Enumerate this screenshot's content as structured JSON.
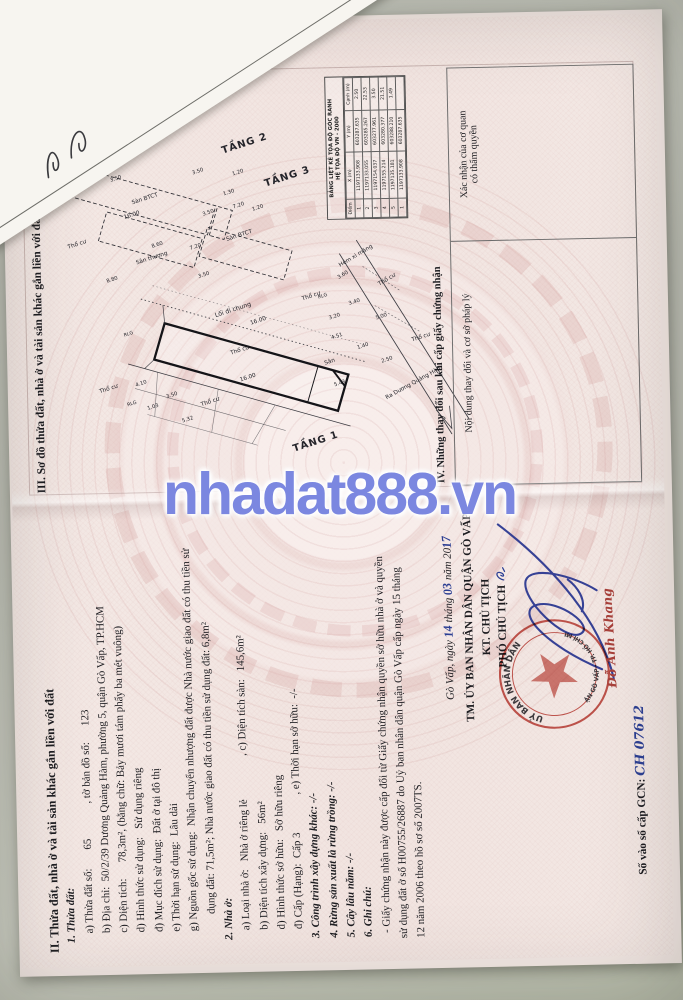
{
  "watermark": "nhadat888.vn",
  "page2": {
    "section2_title": "II. Thửa đất, nhà ở và tài sản khác gắn liền với đất",
    "lines": [
      {
        "t": "1. Thửa đất:",
        "cls": "bi",
        "ind": 10
      },
      {
        "t": "a) Thửa đất số:       65             , tờ bản đồ số:      123",
        "cls": "n",
        "ind": 20
      },
      {
        "t": "b) Địa chỉ:  50/2/39 Dương Quảng Hàm, phường 5, quận Gò Vấp, TP.HCM",
        "cls": "n",
        "ind": 20
      },
      {
        "t": "c) Diện tích:      78,3m², (bằng chữ: Bảy mươi tám phẩy ba mét vuông)",
        "cls": "n",
        "ind": 20
      },
      {
        "t": "d) Hình thức sử dụng:   Sử dụng riêng",
        "cls": "n",
        "ind": 20
      },
      {
        "t": "đ) Mục đích sử dụng:  Đất ở tại đô thị",
        "cls": "n",
        "ind": 20
      },
      {
        "t": "e) Thời hạn sử dụng:  Lâu dài",
        "cls": "n",
        "ind": 20
      },
      {
        "t": "g) Nguồn gốc sử dụng:  Nhận chuyển nhượng đất được Nhà nước giao đất có thu tiền sử",
        "cls": "n",
        "ind": 20
      },
      {
        "t": "dụng đất: 71,5m²; Nhà nước giao đất có thu tiền sử dụng đất: 6,8m²",
        "cls": "n",
        "ind": 38
      },
      {
        "t": "2. Nhà ở:",
        "cls": "bi",
        "ind": 10
      },
      {
        "t": "a) Loại nhà ở:   Nhà ở riêng lẻ                , c) Diện tích sàn:   145,6m²",
        "cls": "n",
        "ind": 20
      },
      {
        "t": "b) Diện tích xây dựng:   56m²",
        "cls": "n",
        "ind": 20
      },
      {
        "t": "d) Hình thức sở hữu:   Sở hữu riêng",
        "cls": "n",
        "ind": 20
      },
      {
        "t": "đ) Cấp (Hạng):  Cấp 3              , e) Thời hạn sở hữu:  -/-",
        "cls": "n",
        "ind": 20
      },
      {
        "t": "3. Công trình xây dựng khác: -/-",
        "cls": "bi",
        "ind": 10
      },
      {
        "t": "4. Rừng sản xuất là rừng trồng: -/-",
        "cls": "bi",
        "ind": 10
      },
      {
        "t": "5. Cây lâu năm: -/-",
        "cls": "bi",
        "ind": 10
      },
      {
        "t": "6. Ghi chú:",
        "cls": "bi",
        "ind": 10
      },
      {
        "t": "- Giấy chứng nhận này được cấp đổi từ Giấy chứng nhận quyền sở hữu nhà ở và quyền",
        "cls": "n",
        "ind": 14
      },
      {
        "t": "sử dụng đất ở số H00755/26887 do Uỷ ban nhân dân quận Gò Vấp cấp ngày 15 tháng",
        "cls": "n",
        "ind": 8
      },
      {
        "t": "12 năm 2006 theo hồ sơ số 2007TS.",
        "cls": "n",
        "ind": 8
      }
    ],
    "sign": {
      "place": "Gò Vấp, ngày ",
      "day": "14",
      "thang": " tháng ",
      "month": "03",
      "nam": " năm 20",
      "year": "17",
      "authority": "TM. ỦY BAN NHÂN DÂN QUẬN GÒ VẤP",
      "kt": "KT. CHỦ TỊCH",
      "deputy": "PHÓ CHỦ TỊCH",
      "signer": "Đỗ Anh Khang",
      "seal_top": "UỶ BAN NHÂN DÂN",
      "seal_bottom": "QUẬN GÒ VẤP · TP. HỒ CHÍ MINH",
      "gcn_label": "Số vào sổ cấp GCN: ",
      "gcn_value": "CH 07612"
    }
  },
  "page3": {
    "section3_title": "III. Sơ đồ thửa đất, nhà ở và tài sản khác gắn liền với đất",
    "coord_table": {
      "title1": "BẢNG LIỆT KÊ TỌA ĐỘ GÓC RANH",
      "title2": "HỆ TỌA ĐỘ VN - 2000",
      "headers": [
        "Điểm",
        "X (m)",
        "Y (m)",
        "Cạnh (m)"
      ],
      "rows": [
        [
          "1",
          "1197133.908",
          "603287.635",
          "2.50"
        ],
        [
          "2",
          "1197133.055",
          "603285.267",
          "22.53"
        ],
        [
          "3",
          "1197154.037",
          "603277.961",
          "3.50"
        ],
        [
          "4",
          "1197155.214",
          "603280.377",
          "21.51"
        ],
        [
          "5",
          "1197135.181",
          "603288.210",
          "1.49"
        ],
        [
          "1",
          "1197133.908",
          "603287.635",
          ""
        ]
      ]
    },
    "section4_title": "IV. Những thay đổi sau khi cấp giấy chứng nhận",
    "col1_header": "Nội dung thay đổi và cơ sở pháp lý",
    "col2_header_line1": "Xác nhận của cơ quan",
    "col2_header_line2": "có thẩm quyền",
    "plan_labels": [
      {
        "t": "TẦNG 1",
        "x": 50,
        "y": 320,
        "r": 73,
        "s": 10.5,
        "b": 1
      },
      {
        "t": "TẦNG 2",
        "x": 368,
        "y": 252,
        "r": 73,
        "s": 10.5,
        "b": 1
      },
      {
        "t": "TẦNG 3",
        "x": 332,
        "y": 296,
        "r": 73,
        "s": 10.5,
        "b": 1
      },
      {
        "t": "Sàn BTCT",
        "x": 313,
        "y": 146,
        "r": 73,
        "s": 6
      },
      {
        "t": "Sàn BTCT",
        "x": 272,
        "y": 244,
        "r": 73,
        "s": 6
      },
      {
        "t": "Sân thượng",
        "x": 250,
        "y": 152,
        "r": 73,
        "s": 6
      },
      {
        "t": "Sân",
        "x": 136,
        "y": 336,
        "r": 73,
        "s": 6
      },
      {
        "t": "Lối đi chung",
        "x": 193,
        "y": 236,
        "r": 73,
        "s": 6.5
      },
      {
        "t": "Hẻm xi măng",
        "x": 248,
        "y": 366,
        "r": 60,
        "s": 6
      },
      {
        "t": "Ra Dương Quảng Hàm",
        "x": 112,
        "y": 424,
        "r": 62,
        "s": 6
      },
      {
        "t": "16.00",
        "x": 121,
        "y": 250,
        "r": 73,
        "s": 6
      },
      {
        "t": "16.00",
        "x": 181,
        "y": 262,
        "r": 73,
        "s": 6
      },
      {
        "t": "16.00",
        "x": 296,
        "y": 132,
        "r": 73,
        "s": 6
      },
      {
        "t": "3.50",
        "x": 335,
        "y": 116,
        "r": 73,
        "s": 5.5
      },
      {
        "t": "3.50",
        "x": 341,
        "y": 202,
        "r": 73,
        "s": 5.5
      },
      {
        "t": "1.30",
        "x": 318,
        "y": 234,
        "r": 73,
        "s": 5.5
      },
      {
        "t": "1.20",
        "x": 339,
        "y": 244,
        "r": 73,
        "s": 5.5
      },
      {
        "t": "8.80",
        "x": 228,
        "y": 110,
        "r": 73,
        "s": 5.5
      },
      {
        "t": "8.60",
        "x": 264,
        "y": 158,
        "r": 73,
        "s": 5.5
      },
      {
        "t": "3.50",
        "x": 231,
        "y": 206,
        "r": 73,
        "s": 5.5
      },
      {
        "t": "7.20",
        "x": 261,
        "y": 198,
        "r": 73,
        "s": 5.5
      },
      {
        "t": "7.20",
        "x": 304,
        "y": 244,
        "r": 73,
        "s": 5.5
      },
      {
        "t": "3.50",
        "x": 297,
        "y": 212,
        "r": 73,
        "s": 5.5
      },
      {
        "t": "1.20",
        "x": 301,
        "y": 264,
        "r": 73,
        "s": 5.5
      },
      {
        "t": "1.03",
        "x": 92,
        "y": 150,
        "r": 73,
        "s": 5.5
      },
      {
        "t": "4.10",
        "x": 117,
        "y": 138,
        "r": 73,
        "s": 5.5
      },
      {
        "t": "3.50",
        "x": 104,
        "y": 170,
        "r": 73,
        "s": 5.5
      },
      {
        "t": "5.32",
        "x": 78,
        "y": 186,
        "r": 73,
        "s": 5.5
      },
      {
        "t": "4.51",
        "x": 163,
        "y": 344,
        "r": 73,
        "s": 5.5
      },
      {
        "t": "1.40",
        "x": 152,
        "y": 371,
        "r": 73,
        "s": 5.5
      },
      {
        "t": "5.43",
        "x": 113,
        "y": 346,
        "r": 73,
        "s": 5.5
      },
      {
        "t": "3.20",
        "x": 184,
        "y": 342,
        "r": 73,
        "s": 5.5
      },
      {
        "t": "3.40",
        "x": 199,
        "y": 363,
        "r": 73,
        "s": 5.5
      },
      {
        "t": "5.00",
        "x": 183,
        "y": 391,
        "r": 73,
        "s": 5.5
      },
      {
        "t": "2.50",
        "x": 137,
        "y": 396,
        "r": 73,
        "s": 5.5
      },
      {
        "t": "3.60",
        "x": 228,
        "y": 352,
        "r": 60,
        "s": 5.5
      },
      {
        "t": "RLG",
        "x": 170,
        "y": 126,
        "r": 73,
        "s": 5
      },
      {
        "t": "RLG",
        "x": 206,
        "y": 330,
        "r": 73,
        "s": 5
      },
      {
        "t": "RLG",
        "x": 96,
        "y": 128,
        "r": 73,
        "s": 5
      },
      {
        "t": "Thổ cư",
        "x": 112,
        "y": 104,
        "r": 73,
        "s": 6
      },
      {
        "t": "Thổ cư",
        "x": 150,
        "y": 242,
        "r": 73,
        "s": 6
      },
      {
        "t": "Thổ cư",
        "x": 206,
        "y": 318,
        "r": 73,
        "s": 6
      },
      {
        "t": "Thổ cư",
        "x": 160,
        "y": 432,
        "r": 73,
        "s": 6
      },
      {
        "t": "Thổ cư",
        "x": 266,
        "y": 74,
        "r": 73,
        "s": 6
      },
      {
        "t": "Thổ cư",
        "x": 96,
        "y": 210,
        "r": 73,
        "s": 6
      },
      {
        "t": "Thổ cư",
        "x": 222,
        "y": 398,
        "r": 60,
        "s": 6
      }
    ]
  }
}
